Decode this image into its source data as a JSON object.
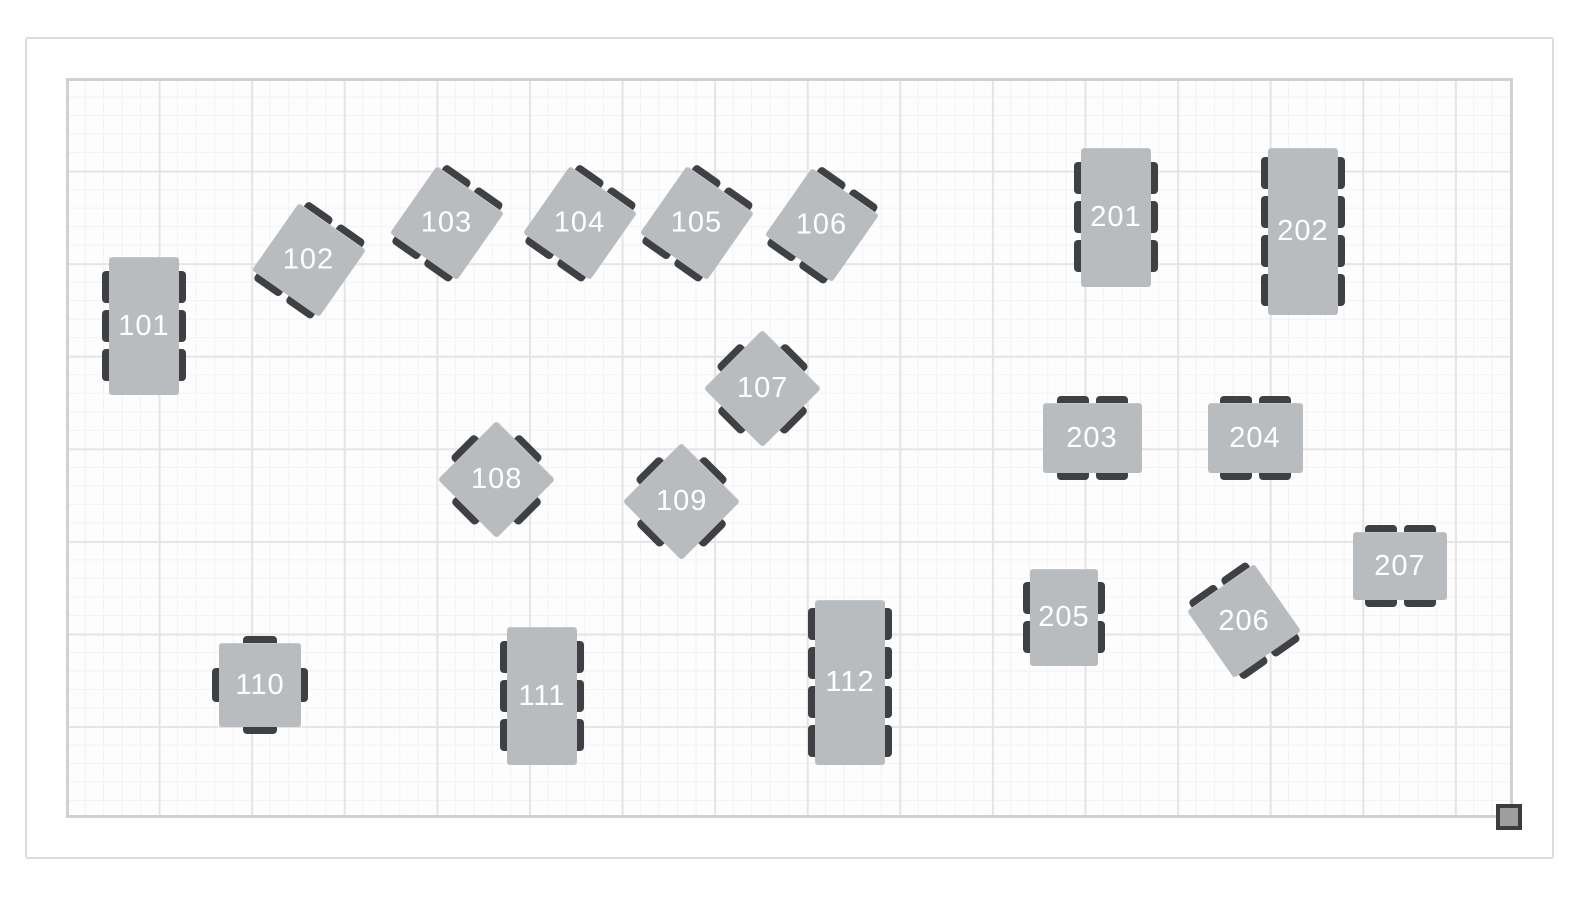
{
  "floor_plan": {
    "colors": {
      "page_background": "#ffffff",
      "frame_border": "#dcdbdb",
      "room_border": "#d2d0d0",
      "grid_minor_line": "#f3f1f1",
      "grid_major_line": "#e6e4e4",
      "table_fill": "#b9bcbf",
      "chair_fill": "#3f4043",
      "label_text": "#ffffff",
      "handle_fill": "#9e9e9e",
      "handle_border": "#3d3d3d"
    },
    "grid": {
      "minor_spacing_px": 18.52,
      "major_spacing_px": 92.6,
      "room_width_px": 1441,
      "room_height_px": 734
    },
    "resize_handle": {
      "name": "room-resize-handle"
    },
    "tables": [
      {
        "label": "101",
        "shape": "rectangle",
        "seats": 6,
        "cx": 75,
        "cy": 245,
        "w": 70,
        "h": 138,
        "rotation": 0,
        "chairs": {
          "left": 3,
          "right": 3
        }
      },
      {
        "label": "102",
        "shape": "square",
        "seats": 4,
        "cx": 240,
        "cy": 179,
        "w": 82,
        "h": 82,
        "rotation": 35,
        "chairs": {
          "top": 2,
          "bottom": 2
        }
      },
      {
        "label": "103",
        "shape": "square",
        "seats": 4,
        "cx": 378,
        "cy": 142,
        "w": 82,
        "h": 82,
        "rotation": 35,
        "chairs": {
          "top": 2,
          "bottom": 2
        }
      },
      {
        "label": "104",
        "shape": "square",
        "seats": 4,
        "cx": 511,
        "cy": 142,
        "w": 82,
        "h": 82,
        "rotation": 35,
        "chairs": {
          "top": 2,
          "bottom": 2
        }
      },
      {
        "label": "105",
        "shape": "square",
        "seats": 4,
        "cx": 628,
        "cy": 142,
        "w": 82,
        "h": 82,
        "rotation": 35,
        "chairs": {
          "top": 2,
          "bottom": 2
        }
      },
      {
        "label": "106",
        "shape": "square",
        "seats": 4,
        "cx": 753,
        "cy": 144,
        "w": 82,
        "h": 82,
        "rotation": 35,
        "chairs": {
          "top": 2,
          "bottom": 2
        }
      },
      {
        "label": "107",
        "shape": "square",
        "seats": 4,
        "cx": 693,
        "cy": 307,
        "w": 83,
        "h": 83,
        "rotation": 45,
        "chairs": {
          "top": 1,
          "right": 1,
          "bottom": 1,
          "left": 1
        }
      },
      {
        "label": "108",
        "shape": "square",
        "seats": 4,
        "cx": 427,
        "cy": 398,
        "w": 83,
        "h": 83,
        "rotation": 45,
        "chairs": {
          "top": 1,
          "right": 1,
          "bottom": 1,
          "left": 1
        }
      },
      {
        "label": "109",
        "shape": "square",
        "seats": 4,
        "cx": 612,
        "cy": 420,
        "w": 83,
        "h": 83,
        "rotation": 45,
        "chairs": {
          "top": 1,
          "right": 1,
          "bottom": 1,
          "left": 1
        }
      },
      {
        "label": "110",
        "shape": "square",
        "seats": 4,
        "cx": 191,
        "cy": 604,
        "w": 82,
        "h": 84,
        "rotation": 0,
        "chairs": {
          "top": 1,
          "right": 1,
          "bottom": 1,
          "left": 1
        }
      },
      {
        "label": "111",
        "shape": "rectangle",
        "seats": 6,
        "cx": 473,
        "cy": 615,
        "w": 70,
        "h": 138,
        "rotation": 0,
        "chairs": {
          "left": 3,
          "right": 3
        }
      },
      {
        "label": "112",
        "shape": "rectangle",
        "seats": 8,
        "cx": 781,
        "cy": 601,
        "w": 70,
        "h": 165,
        "rotation": 0,
        "chairs": {
          "left": 4,
          "right": 4
        }
      },
      {
        "label": "201",
        "shape": "rectangle",
        "seats": 6,
        "cx": 1047,
        "cy": 136,
        "w": 70,
        "h": 139,
        "rotation": 0,
        "chairs": {
          "left": 3,
          "right": 3
        }
      },
      {
        "label": "202",
        "shape": "rectangle",
        "seats": 8,
        "cx": 1234,
        "cy": 150,
        "w": 70,
        "h": 167,
        "rotation": 0,
        "chairs": {
          "left": 4,
          "right": 4
        }
      },
      {
        "label": "203",
        "shape": "rectangle",
        "seats": 4,
        "cx": 1023,
        "cy": 357,
        "w": 99,
        "h": 70,
        "rotation": 0,
        "chairs": {
          "top": 2,
          "bottom": 2
        }
      },
      {
        "label": "204",
        "shape": "rectangle",
        "seats": 4,
        "cx": 1186,
        "cy": 357,
        "w": 95,
        "h": 70,
        "rotation": 0,
        "chairs": {
          "top": 2,
          "bottom": 2
        }
      },
      {
        "label": "205",
        "shape": "rectangle",
        "seats": 4,
        "cx": 995,
        "cy": 536,
        "w": 68,
        "h": 97,
        "rotation": 0,
        "chairs": {
          "left": 2,
          "right": 2
        }
      },
      {
        "label": "206",
        "shape": "square",
        "seats": 4,
        "cx": 1175,
        "cy": 540,
        "w": 82,
        "h": 82,
        "rotation": -35,
        "chairs": {
          "top": 2,
          "bottom": 2
        }
      },
      {
        "label": "207",
        "shape": "rectangle",
        "seats": 4,
        "cx": 1331,
        "cy": 485,
        "w": 94,
        "h": 68,
        "rotation": 0,
        "chairs": {
          "top": 2,
          "bottom": 2
        }
      }
    ]
  }
}
